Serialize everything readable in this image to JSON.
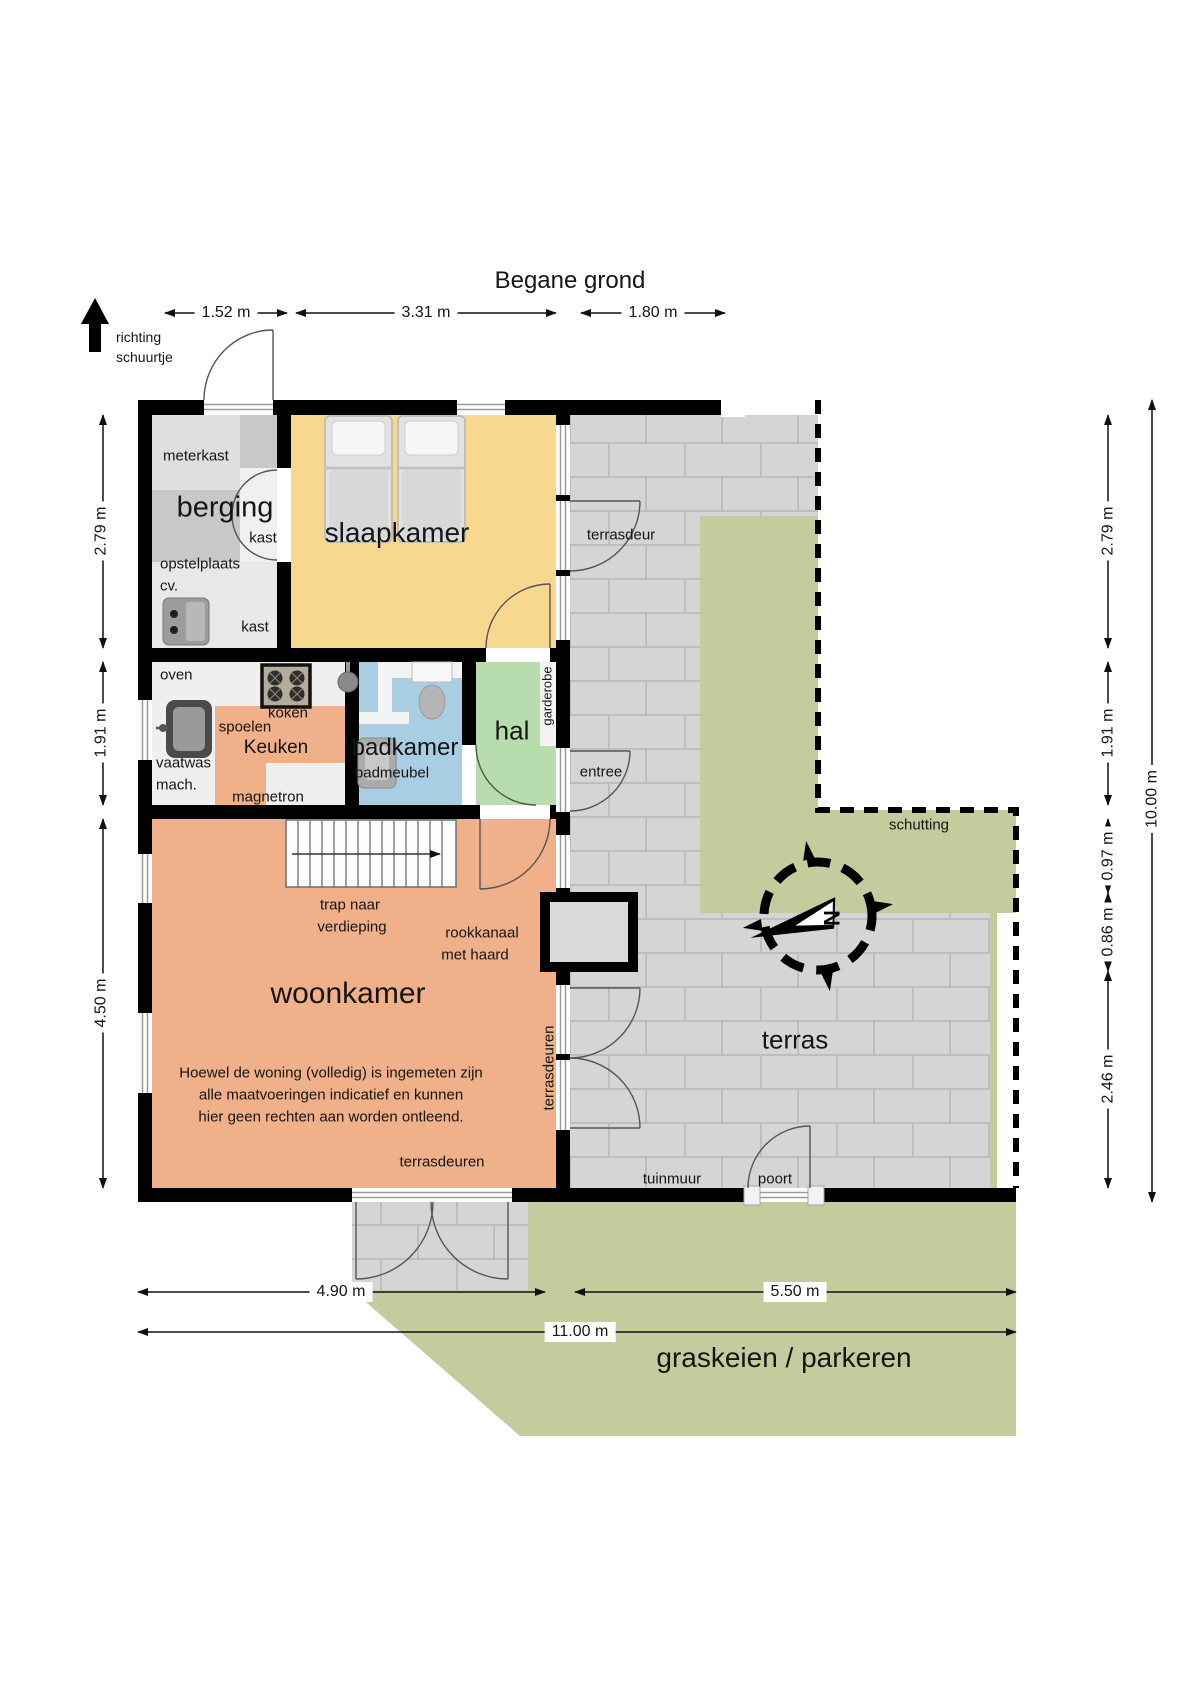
{
  "title": "Begane grond",
  "direction_note": {
    "line1": "richting",
    "line2": "schuurtje"
  },
  "compass": {
    "north_label": "N"
  },
  "rooms": {
    "berging": "berging",
    "slaapkamer": "slaapkamer",
    "badkamer": "badkamer",
    "hal": "hal",
    "keuken": "Keuken",
    "woonkamer": "woonkamer",
    "terras": "terras"
  },
  "features": {
    "meterkast": "meterkast",
    "kast_upper": "kast",
    "kast_lower": "kast",
    "opstelplaats_line1": "opstelplaats",
    "opstelplaats_line2": "cv.",
    "oven": "oven",
    "koken": "koken",
    "spoelen": "spoelen",
    "vaatwas_line1": "vaatwas",
    "vaatwas_line2": "mach.",
    "magnetron": "magnetron",
    "badmeubel": "badmeubel",
    "garderobe": "garderobe",
    "trap_line1": "trap naar",
    "trap_line2": "verdieping",
    "rookkanaal_line1": "rookkanaal",
    "rookkanaal_line2": "met haard"
  },
  "doors": {
    "terrasdeur": "terrasdeur",
    "entree": "entree",
    "terrasdeuren_wall": "terrasdeuren",
    "terrasdeuren_bottom": "terrasdeuren",
    "poort": "poort"
  },
  "outdoor": {
    "schutting": "schutting",
    "tuinmuur": "tuinmuur",
    "graskeien": "graskeien / parkeren"
  },
  "disclaimer": {
    "line1": "Hoewel de woning (volledig) is ingemeten zijn",
    "line2": "alle maatvoeringen indicatief en kunnen",
    "line3": "hier geen rechten aan worden ontleend."
  },
  "dimensions": {
    "top": [
      "1.52 m",
      "3.31 m",
      "1.80 m"
    ],
    "left": [
      "2.79 m",
      "1.91 m",
      "4.50 m"
    ],
    "right": [
      "2.79 m",
      "1.91 m",
      "0.97 m",
      "0.86 m",
      "2.46 m"
    ],
    "right_total": "10.00 m",
    "bottom": [
      "4.90 m",
      "5.50 m"
    ],
    "bottom_total": "11.00 m"
  },
  "palette": {
    "wall": "#000000",
    "slaapkamer_floor": "#f7d88e",
    "woonkamer_floor": "#f0b089",
    "badkamer_floor": "#a9cde2",
    "hal_floor": "#b7dcae",
    "berging_floor": "#c8c8c8",
    "terras_tile": "#d5d5d5",
    "grass": "#c3cc9d"
  }
}
